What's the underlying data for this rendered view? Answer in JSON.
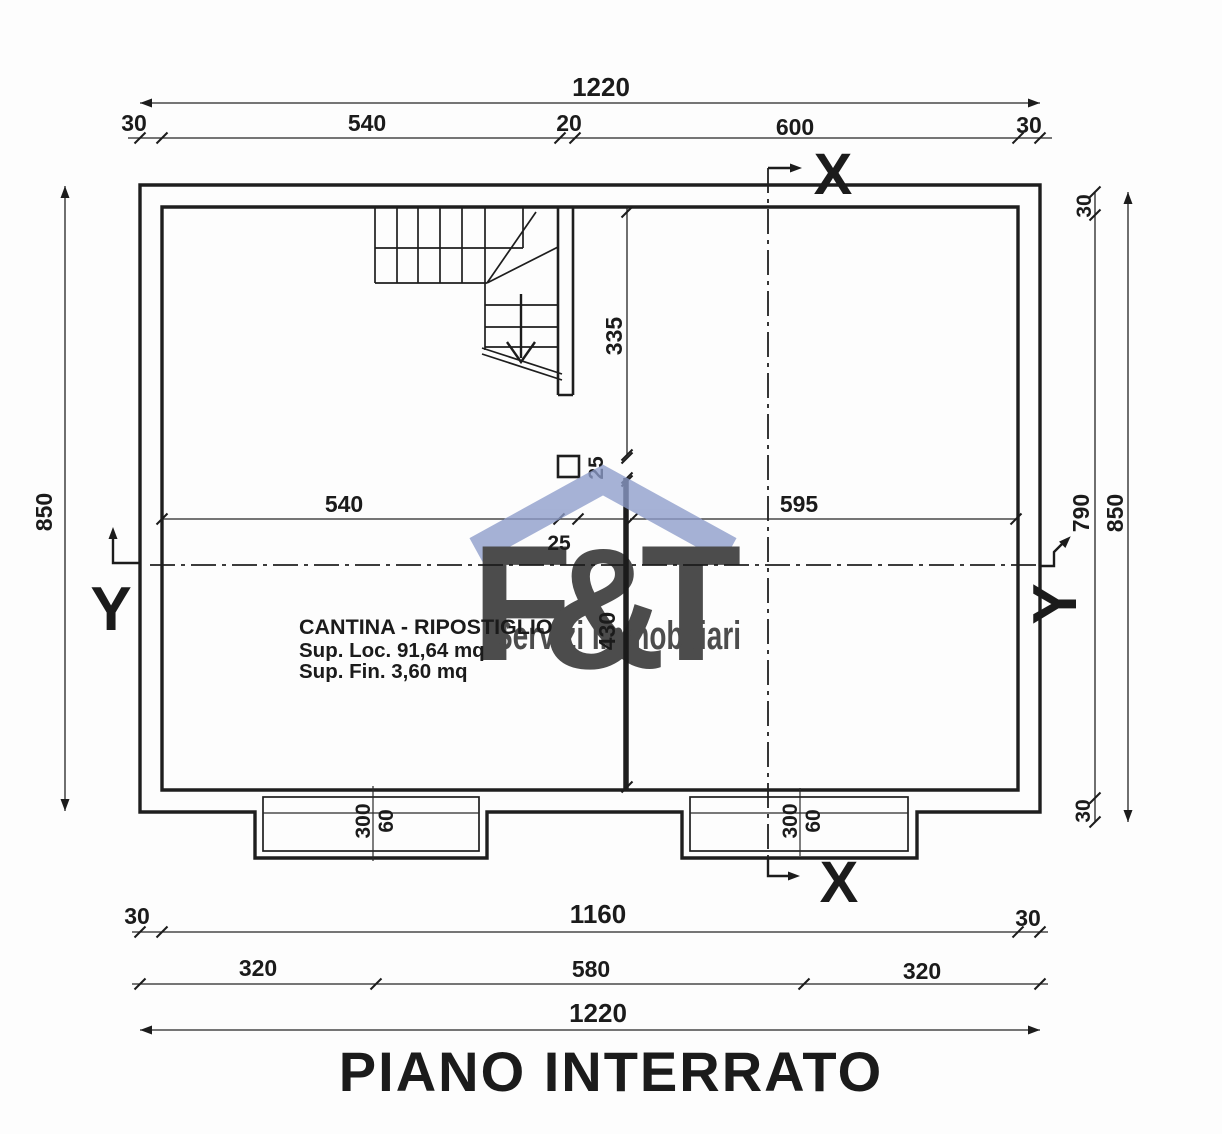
{
  "page": {
    "background": "#fdfdfd",
    "line_color": "#1e1e1e"
  },
  "title": "PIANO INTERRATO",
  "room": {
    "name": "CANTINA - RIPOSTIGLIO",
    "surface_line1": "Sup. Loc. 91,64 mq",
    "surface_line2": "Sup. Fin. 3,60 mq"
  },
  "section_markers": {
    "x": "X",
    "y": "Y"
  },
  "dimensions": {
    "top": {
      "total": "1220",
      "chain": [
        "30",
        "540",
        "20",
        "600",
        "30"
      ]
    },
    "bottom": {
      "row1": [
        "30",
        "1160",
        "30"
      ],
      "row2": [
        "320",
        "580",
        "320"
      ],
      "total": "1220"
    },
    "left": {
      "total": "850"
    },
    "right": {
      "wall_top": "30",
      "interior": "790",
      "total": "850",
      "wall_bottom": "30"
    },
    "interior": {
      "stair_bay_depth": "335",
      "pillar_width": "25",
      "pillar_height": "25",
      "left_bay": "540",
      "right_bay": "595",
      "lower_bay": "430"
    },
    "lightwell": {
      "width": "300",
      "depth": "60"
    }
  },
  "watermark": {
    "letter_f": "F",
    "ampersand": "&",
    "letter_t": "T",
    "subtitle": "Servizi Immobiliari"
  },
  "colors": {
    "watermark_gray": "#c7c7c7",
    "watermark_blue": "#8d9cca",
    "subtitle_blue": "#7b8fc4"
  }
}
